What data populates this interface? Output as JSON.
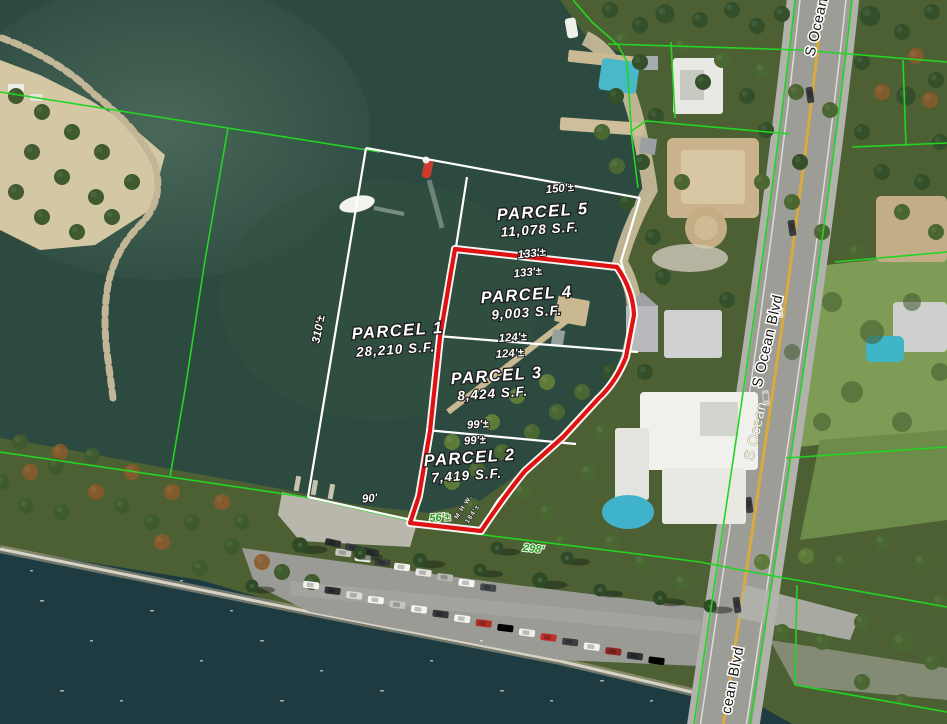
{
  "map": {
    "description": "aerial parcel map with GIS overlay",
    "parcels": [
      {
        "name": "PARCEL 1",
        "area": "28,210 S.F."
      },
      {
        "name": "PARCEL 2",
        "area": "7,419 S.F."
      },
      {
        "name": "PARCEL 3",
        "area": "8,424 S.F."
      },
      {
        "name": "PARCEL 4",
        "area": "9,003 S.F."
      },
      {
        "name": "PARCEL 5",
        "area": "11,078 S.F."
      }
    ],
    "dimensions": {
      "d150": "150'±",
      "d133a": "133'±",
      "d133b": "133'±",
      "d310": "310'±",
      "d124a": "124'±",
      "d124b": "124'±",
      "d99a": "99'±",
      "d99b": "99'±",
      "d90": "90'",
      "d56": "56'±",
      "d298": "298'",
      "mhw": "M.H.W.",
      "mhw2": "184'±"
    },
    "street_labels": {
      "top": "S Ocean",
      "mid": "S Ocean Blvd",
      "mid_secondary": "S Ocean",
      "bottom": "cean Blvd"
    },
    "colors": {
      "boundary_green": "#23d523",
      "survey_white": "#ffffff",
      "highlight_red": "#de1212",
      "dim_green_text": "#1f9e1f"
    }
  }
}
